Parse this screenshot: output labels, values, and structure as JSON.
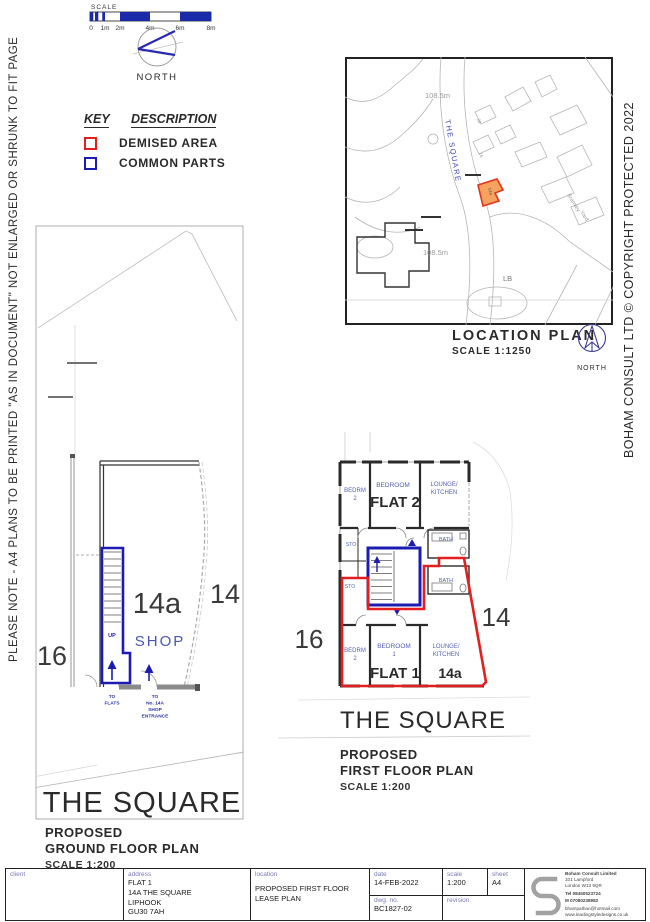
{
  "page": {
    "left_note": "PLEASE NOTE - A4 PLANS TO BE PRINTED \"AS IN DOCUMENT\" NOT ENLARGED OR SHRUNK TO FIT PAGE",
    "right_copyright": "BOHAM CONSULT LTD © COPYRIGHT PROTECTED 2022"
  },
  "scale_bar": {
    "label": "SCALE",
    "ticks": [
      "0",
      "1m",
      "2m",
      "4m",
      "6m",
      "8m"
    ]
  },
  "north_main": {
    "label": "NORTH"
  },
  "key": {
    "heading_key": "KEY",
    "heading_desc": "DESCRIPTION",
    "demised_label": "DEMISED AREA",
    "common_label": "COMMON PARTS",
    "demised_color": "#e41e1e",
    "common_color": "#1c1cb4"
  },
  "location_plan": {
    "title": "LOCATION PLAN",
    "scale": "SCALE 1:1250",
    "north_label": "NORTH",
    "street": "THE SQUARE",
    "level_a": "108.5m",
    "level_b": "108.5m",
    "lb": "LB",
    "bramley": "Bramley",
    "yard": "Yard",
    "plot": "14a",
    "n28": "28",
    "n16": "16"
  },
  "ground_floor": {
    "n16": "16",
    "n14a": "14a",
    "n14": "14",
    "shop": "SHOP",
    "up": "UP",
    "to_flats_1": "TO",
    "to_flats_2": "FLATS",
    "to_shop_1": "TO",
    "to_shop_2": "No. 14A",
    "to_shop_3": "SHOP",
    "to_shop_4": "ENTRANCE",
    "street": "THE SQUARE",
    "caption1": "PROPOSED",
    "caption2": "GROUND FLOOR PLAN",
    "caption3": "SCALE 1:200"
  },
  "first_floor": {
    "n16": "16",
    "n14": "14",
    "n14a": "14a",
    "flat2": "FLAT 2",
    "flat1": "FLAT 1",
    "f2_bedrm": "BEDRM",
    "f2_bedrm_no": "2",
    "f2_bedroom": "BEDROOM",
    "f2_lounge1": "LOUNGE/",
    "f2_lounge2": "KITCHEN",
    "sto_a": "STO",
    "sto_b": "STO",
    "bath_a": "BATH",
    "bath_b": "BATH",
    "f1_bedrm": "BEDRM",
    "f1_bedrm_no": "2",
    "f1_bedroom": "BEDROOM",
    "f1_bedroom_no": "1",
    "f1_lounge1": "LOUNGE/",
    "f1_lounge2": "KITCHEN",
    "street": "THE SQUARE",
    "caption1": "PROPOSED",
    "caption2": "FIRST FLOOR PLAN",
    "caption3": "SCALE 1:200"
  },
  "title_block": {
    "client_label": "client",
    "address_label": "address",
    "address1": "FLAT 1",
    "address2": "14A THE SQUARE",
    "address3": "LIPHOOK",
    "address4": "GU30 7AH",
    "location_label": "location",
    "location1": "PROPOSED FIRST FLOOR",
    "location2": "LEASE PLAN",
    "date_label": "date",
    "date": "14-FEB-2022",
    "scale_label": "scale",
    "scale": "1:200",
    "sheet_label": "sheet",
    "sheet": "A4",
    "dwg_label": "dwg. no.",
    "dwg": "BC1827-02",
    "revision_label": "revision",
    "company": {
      "line1": "Boham Consult Limited",
      "line2": "101 Lampford",
      "line3": "London  W13 9QR",
      "line4": "Tel 08450523724",
      "line5": "M 07080238982",
      "line6": "bhampathan@hotmail.com",
      "line7": "www.leadingstyledesigns.co.uk"
    }
  }
}
